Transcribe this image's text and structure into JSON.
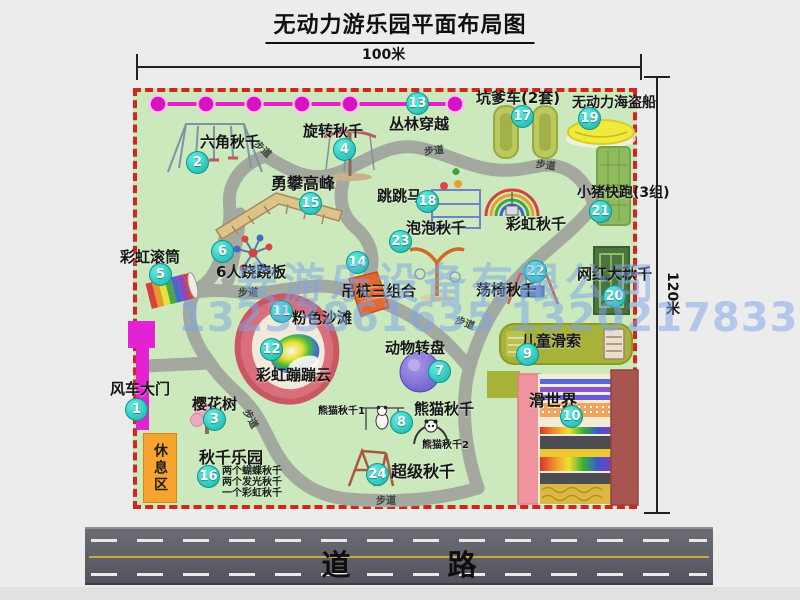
{
  "title": "无动力游乐园平面布局图",
  "dimensions": {
    "horizontal": "100米",
    "vertical": "120米"
  },
  "road": {
    "label": "道　路"
  },
  "rest_area": {
    "label": "休息区"
  },
  "watermark": {
    "company": "安游乐设备有限公司",
    "phones": "13233861635 13202178333"
  },
  "park": {
    "items": [
      {
        "num": 1,
        "label": "风车大门",
        "lx": 110,
        "ly": 381,
        "bx": 137,
        "by": 410
      },
      {
        "num": 2,
        "label": "六角秋千",
        "lx": 200,
        "ly": 134,
        "bx": 198,
        "by": 163
      },
      {
        "num": 3,
        "label": "樱花树",
        "lx": 192,
        "ly": 396,
        "bx": 215,
        "by": 420
      },
      {
        "num": 4,
        "label": "旋转秋千",
        "lx": 303,
        "ly": 123,
        "bx": 345,
        "by": 150
      },
      {
        "num": 5,
        "label": "彩虹滚筒",
        "lx": 120,
        "ly": 249,
        "bx": 161,
        "by": 275
      },
      {
        "num": 6,
        "label": "6人跷跷板",
        "lx": 216,
        "ly": 264,
        "bx": 223,
        "by": 252
      },
      {
        "num": 7,
        "label": "动物转盘",
        "lx": 385,
        "ly": 340,
        "bx": 440,
        "by": 372
      },
      {
        "num": 8,
        "label": "熊猫秋千",
        "lx": 414,
        "ly": 401,
        "bx": 402,
        "by": 423
      },
      {
        "num": 9,
        "label": "儿童滑索",
        "lx": 521,
        "ly": 333,
        "bx": 528,
        "by": 355
      },
      {
        "num": 10,
        "label": "滑世界",
        "lx": 529,
        "ly": 392,
        "bx": 572,
        "by": 417,
        "fs": 16
      },
      {
        "num": 11,
        "label": "粉色沙滩",
        "lx": 292,
        "ly": 310,
        "bx": 282,
        "by": 312
      },
      {
        "num": 12,
        "label": "彩虹蹦蹦云",
        "lx": 256,
        "ly": 367,
        "bx": 272,
        "by": 350
      },
      {
        "num": 13,
        "label": "丛林穿越",
        "lx": 389,
        "ly": 116,
        "bx": 418,
        "by": 104
      },
      {
        "num": 14,
        "label": "吊桩三组合",
        "lx": 341,
        "ly": 283,
        "bx": 358,
        "by": 263
      },
      {
        "num": 15,
        "label": "勇攀高峰",
        "lx": 271,
        "ly": 175,
        "bx": 311,
        "by": 204,
        "fs": 16
      },
      {
        "num": 16,
        "label": "秋千乐园",
        "lx": 199,
        "ly": 449,
        "bx": 209,
        "by": 477,
        "fs": 16
      },
      {
        "num": 17,
        "label": "坑爹车(2套)",
        "lx": 476,
        "ly": 90,
        "bx": 523,
        "by": 117
      },
      {
        "num": 18,
        "label": "跳跳马",
        "lx": 377,
        "ly": 188,
        "bx": 428,
        "by": 202
      },
      {
        "num": 19,
        "label": "无动力海盗船",
        "lx": 572,
        "ly": 96,
        "bx": 590,
        "by": 119,
        "fs": 14
      },
      {
        "num": 20,
        "label": "网红大秋千",
        "lx": 577,
        "ly": 266,
        "bx": 615,
        "by": 297
      },
      {
        "num": 21,
        "label": "小猪快跑(3组)",
        "lx": 577,
        "ly": 186,
        "bx": 601,
        "by": 212,
        "fs": 14
      },
      {
        "num": 22,
        "label": "荡椅秋千",
        "lx": 476,
        "ly": 282,
        "bx": 536,
        "by": 272
      },
      {
        "num": 23,
        "label": "泡泡秋千",
        "lx": 406,
        "ly": 220,
        "bx": 401,
        "by": 242
      },
      {
        "num": 24,
        "label": "超级秋千",
        "lx": 391,
        "ly": 463,
        "bx": 378,
        "by": 475,
        "fs": 16
      }
    ],
    "extra_labels": [
      {
        "label": "彩虹秋千",
        "lx": 506,
        "ly": 216,
        "fs": 15
      },
      {
        "label": "熊猫秋千1",
        "lx": 318,
        "ly": 406,
        "fs": 10
      },
      {
        "label": "熊猫秋千2",
        "lx": 422,
        "ly": 440,
        "fs": 10
      }
    ],
    "path_label": "步道",
    "path_labels": [
      {
        "x": 256,
        "y": 134,
        "r": 42
      },
      {
        "x": 424,
        "y": 143,
        "r": -6
      },
      {
        "x": 536,
        "y": 155,
        "r": 8
      },
      {
        "x": 238,
        "y": 284,
        "r": 0
      },
      {
        "x": 247,
        "y": 402,
        "r": 62
      },
      {
        "x": 376,
        "y": 492,
        "r": 0
      },
      {
        "x": 456,
        "y": 311,
        "r": 20
      }
    ],
    "swing_park_notes": [
      "两个蝴蝶秋千",
      "两个发光秋千",
      "一个彩虹秋千"
    ],
    "icons": [
      "zipline-icon",
      "hexagon-swing-icon",
      "rotating-swing-icon",
      "climbing-peak-icon",
      "jumping-horse-icon",
      "rainbow-swing-icon",
      "bubble-swing-icon",
      "hanging-piles-icon",
      "rainbow-roller-icon",
      "seesaw-spinner-icon",
      "pink-beach-icon",
      "animal-carousel-icon",
      "panda-swing1-icon",
      "panda-swing2-icon",
      "super-swing-icon",
      "cherry-tree-icon",
      "pit-cars-icon",
      "pirate-ship-icon",
      "pig-run-icon",
      "big-swing-icon",
      "chair-swing-icon",
      "kids-zipline-icon",
      "slide-world-icon",
      "windmill-gate-icon",
      "walkway-paths"
    ]
  }
}
